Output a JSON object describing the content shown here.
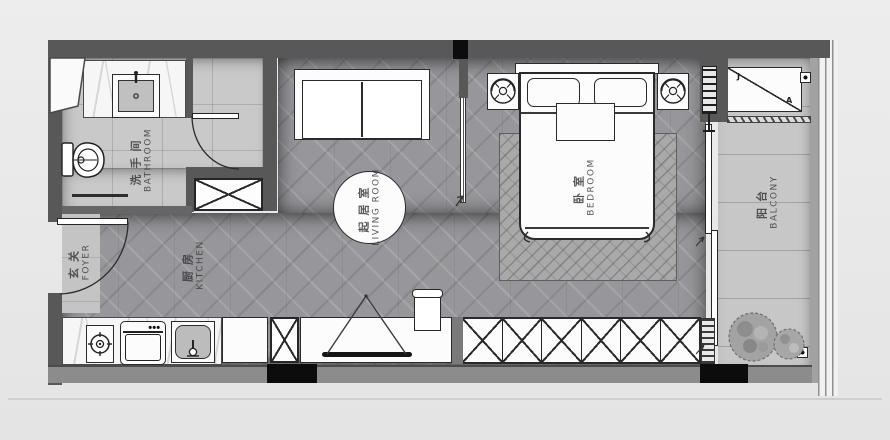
{
  "plan_title": "studio-apartment-floor-plan",
  "rooms": [
    {
      "key": "bathroom",
      "zh": "洗手间",
      "en": "BATHROOM"
    },
    {
      "key": "foyer",
      "zh": "玄关",
      "en": "FOYER"
    },
    {
      "key": "kitchen",
      "zh": "厨房",
      "en": "KITCHEN"
    },
    {
      "key": "living_room",
      "zh": "起居室",
      "en": "LIVING ROOM"
    },
    {
      "key": "bedroom",
      "zh": "卧室",
      "en": "BEDROOM"
    },
    {
      "key": "balcony",
      "zh": "阳台",
      "en": "BALCONY"
    }
  ],
  "cabinet_marks": {
    "left": "J",
    "right": "A"
  },
  "colors": {
    "wall": "#585858",
    "wall_light": "#8c8c8c",
    "accent_black": "#0c0c0c",
    "wood_floor": "#97979b",
    "tile_floor": "#c9c9c9",
    "furniture_line": "#2a2a2a",
    "canvas": "#e8e8e8"
  }
}
